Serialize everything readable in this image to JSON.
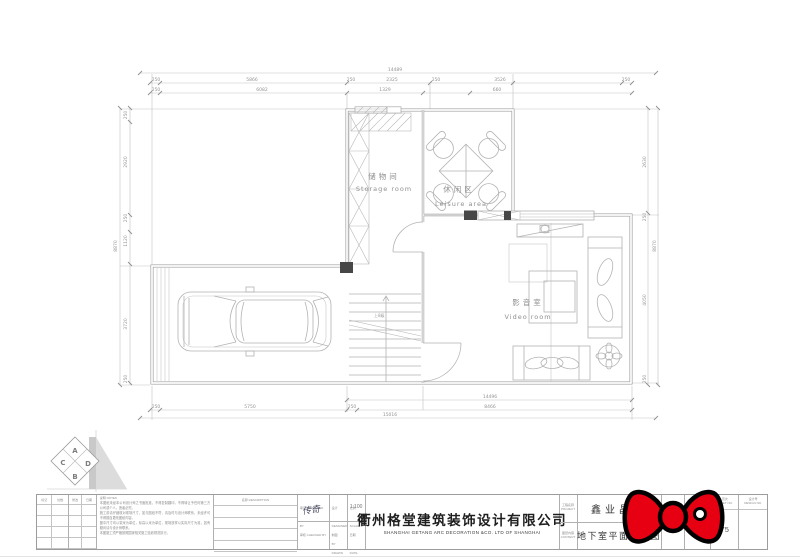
{
  "plan": {
    "rooms": {
      "storage": {
        "cn": "储物间",
        "en": "Storage room"
      },
      "leisure": {
        "cn": "休闲区",
        "en": "Leisure area"
      },
      "video": {
        "cn": "影音室",
        "en": "Video room"
      }
    },
    "stair_label": "上8级",
    "dims": {
      "top_total": "14489",
      "top_segs": [
        "250",
        "5866",
        "250",
        "2325",
        "250",
        "3526",
        "250"
      ],
      "top_inner": [
        "250",
        "6082",
        "1329",
        "660"
      ],
      "left_total": "8870",
      "left_segs": [
        "250",
        "2920",
        "250",
        "1120",
        "3720",
        "250"
      ],
      "right_total": "8870",
      "right_segs": [
        "2630",
        "250",
        "4050",
        "250"
      ],
      "bottom_mid": "14496",
      "bottom_segs": [
        "250",
        "5750",
        "250",
        "8466"
      ],
      "bottom_total": "15016"
    }
  },
  "logo": {
    "a": "A",
    "b": "B",
    "c": "C",
    "d": "D"
  },
  "titleblock": {
    "table1": {
      "h1": "标记",
      "h2": "处数"
    },
    "table2": {
      "h1": "修改",
      "h2": "日期"
    },
    "notes_label": "说明  NOTES",
    "notes": [
      "本图纸未经本公司设计师之书面批准，不得复制翻印，不得转让予任何第三方公司或个人，违者必究。",
      "施工前请仔细核对现场尺寸，如与图纸不符，请及时与设计师联系，未经许可不得擅自更改图纸内容。",
      "图中尺寸均以毫米为单位，标高以米为单位，现场放样以实际尺寸为准，如有疑问请与设计师联系。",
      "本图施工须严格按照国家相关施工验收规范执行。"
    ],
    "desc_label": "名称  DESCRIPTION",
    "approved_label": "审定  APPROVED BY",
    "checked_label": "审核  CHECKED BY",
    "designed_label": "设计  DESIGNED BY",
    "drawn_label": "制图  DRAWN BY",
    "scale_label": "比例  SCALE",
    "date_label": "日期  DATE",
    "signature": "传奇",
    "scale_value": "1:100",
    "company_cn": "衢州格堂建筑装饰设计有限公司",
    "company_en": "SHANGHAI GETANG ARC DECORATION  &CO. LTD OF SHANGHAI",
    "project_label_cn": "工程名称",
    "project_label_en": "PROJECT",
    "content_label_cn": "图纸内容",
    "content_label_en": "CONTENT",
    "project_name": "鑫业晶典",
    "drawing_title": "地下室平面布置图",
    "dwg_label_cn": "图号",
    "dwg_label_en": "DWG NO.",
    "dwg_no": "F-04",
    "sheet_label_cn": "页次",
    "sheet_label_en": "SHEET NO.",
    "sheet_no": "75",
    "design_label_cn": "设计号",
    "design_label_en": "DESIGN NO."
  },
  "colors": {
    "bow_red": "#e60012",
    "column_fill": "#474747",
    "wall_line": "#9b9b9b"
  }
}
